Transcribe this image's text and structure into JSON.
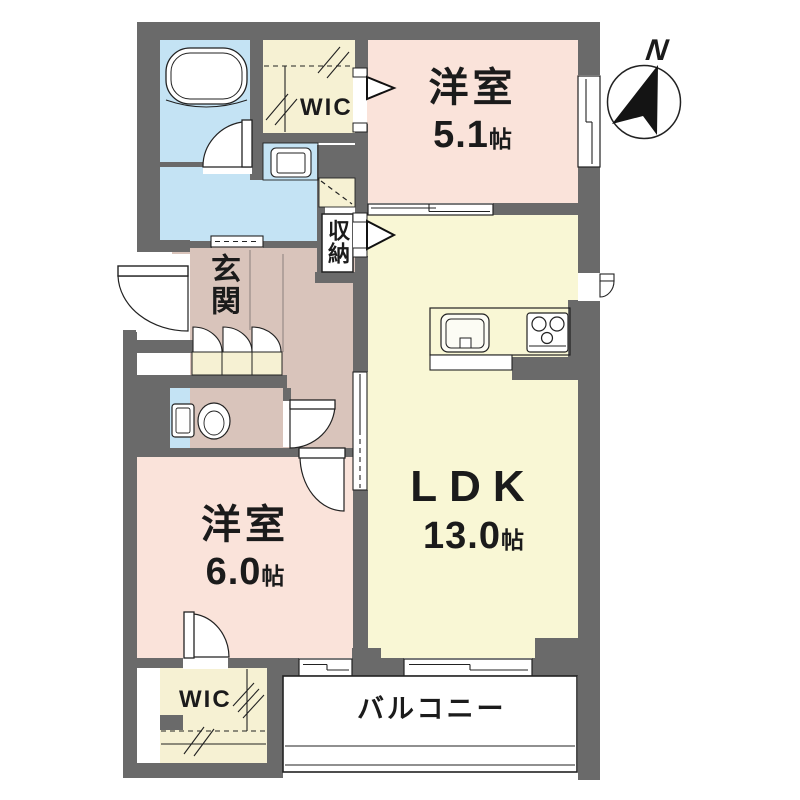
{
  "colors": {
    "wall": "#6a6a6a",
    "bedroom_floor": "#fae3da",
    "ldk_floor": "#f9f7d5",
    "closet_floor": "#f6f1d3",
    "hall_floor": "#d9c4bb",
    "wet_floor": "#c4e3f4",
    "line": "#222222"
  },
  "compass": {
    "north_label": "N"
  },
  "rooms": {
    "bedroom_upper": {
      "name": "洋室",
      "size": "5.1",
      "unit": "帖"
    },
    "ldk": {
      "name": "LDK",
      "size": "13.0",
      "unit": "帖"
    },
    "bedroom_lower": {
      "name": "洋室",
      "size": "6.0",
      "unit": "帖"
    },
    "entrance": {
      "name": "玄関"
    },
    "storage": {
      "name": "収納"
    },
    "wic_upper": {
      "name": "WIC"
    },
    "wic_lower": {
      "name": "WIC"
    },
    "balcony": {
      "name": "バルコニー"
    }
  },
  "fixtures": {
    "bathtub": "bathtub-icon",
    "washing_machine": "washing-machine-icon",
    "toilet": "toilet-icon",
    "kitchen_sink": "kitchen-sink-icon",
    "gas_stove": "gas-stove-icon",
    "compass": "compass-north-icon"
  }
}
